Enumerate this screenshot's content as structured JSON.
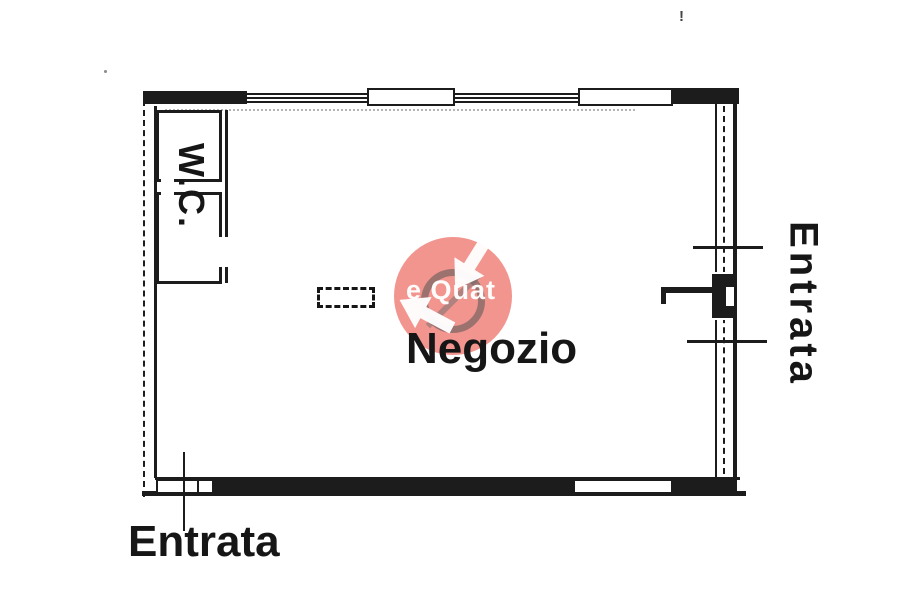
{
  "page": {
    "background": "#ffffff",
    "ink_color": "#1c1c1c"
  },
  "plan": {
    "shop_label": "Negozio",
    "wc_label": "W.C.",
    "entrance_right_label": "Entrata",
    "entrance_bottom_label": "Entrata"
  },
  "marks": {
    "exclamation": "!"
  },
  "watermark": {
    "visible_text": "e Quat",
    "circle_color": "#e73e32",
    "ring_color": "#555555",
    "arrow_color": "#ffffff"
  }
}
